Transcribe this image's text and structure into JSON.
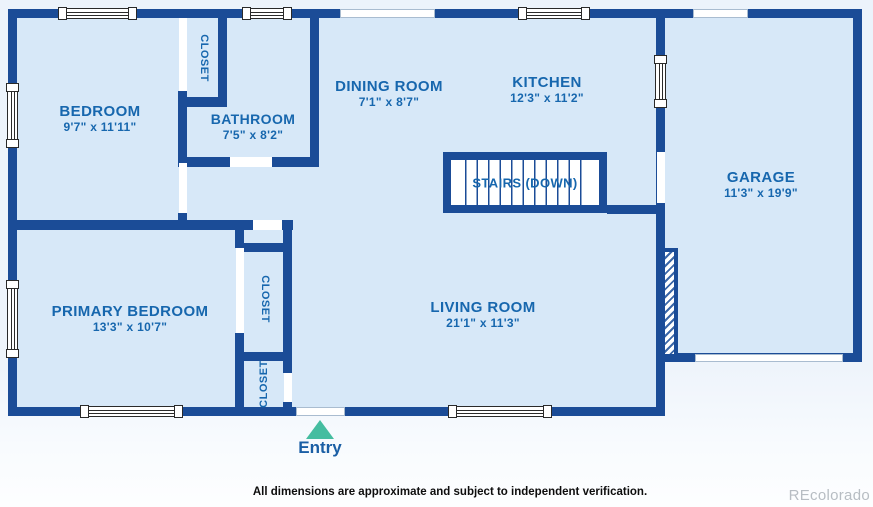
{
  "rooms": {
    "bedroom": {
      "name": "BEDROOM",
      "dims": "9'7\" x 11'11\""
    },
    "bathroom": {
      "name": "BATHROOM",
      "dims": "7'5\" x 8'2\""
    },
    "dining": {
      "name": "DINING ROOM",
      "dims": "7'1\" x 8'7\""
    },
    "kitchen": {
      "name": "KITCHEN",
      "dims": "12'3\" x 11'2\""
    },
    "garage": {
      "name": "GARAGE",
      "dims": "11'3\" x 19'9\""
    },
    "primary_bedroom": {
      "name": "PRIMARY BEDROOM",
      "dims": "13'3\" x 10'7\""
    },
    "living_room": {
      "name": "LIVING ROOM",
      "dims": "21'1\" x 11'3\""
    },
    "stairs": {
      "name": "STAIRS (DOWN)"
    }
  },
  "closets": {
    "top": {
      "label": "CLOSET"
    },
    "middle": {
      "label": "CLOSET"
    },
    "lower": {
      "label": "CLOSET"
    }
  },
  "entry": {
    "label": "Entry"
  },
  "footer": {
    "disclaimer": "All dimensions are approximate and subject to independent verification.",
    "watermark": "REcolorado"
  },
  "colors": {
    "wall": "#1b4c97",
    "room_fill": "#d7e8f8",
    "label_text": "#1767ae",
    "entry_arrow": "#45bda0",
    "watermark_gray": "#b7bdc3"
  }
}
